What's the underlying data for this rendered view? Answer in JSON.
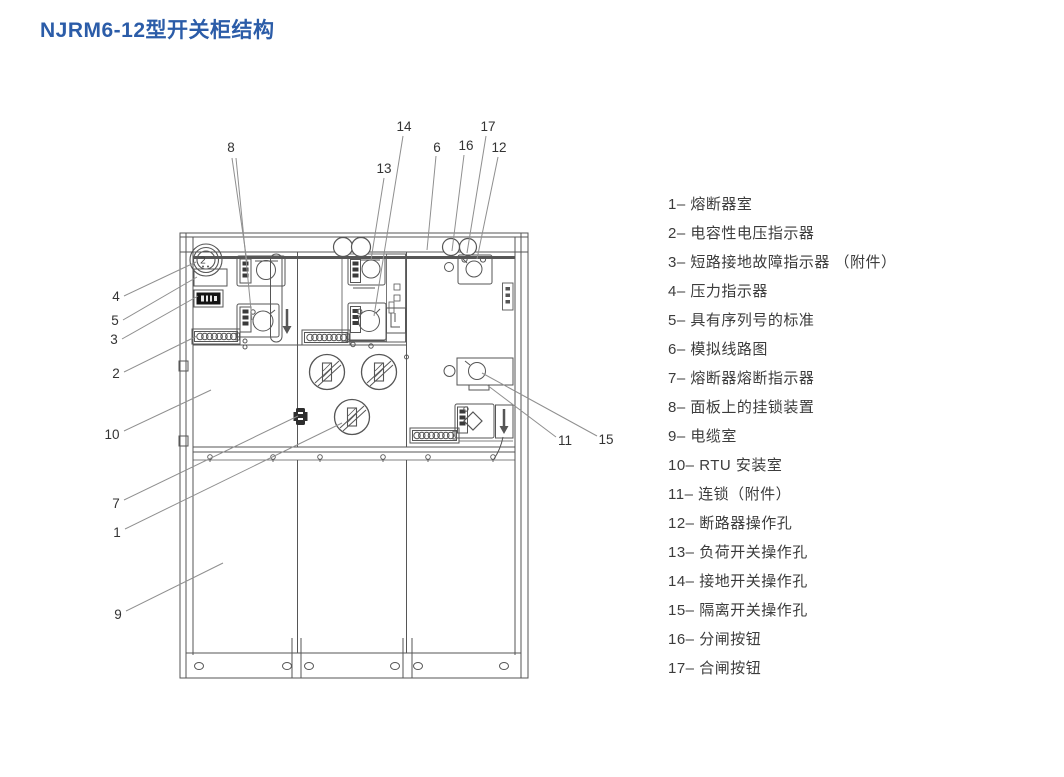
{
  "title": "NJRM6-12型开关柜结构",
  "colors": {
    "title": "#2b5ca8",
    "diagram_line": "#565656",
    "leader_line": "#8f8f8f",
    "legend_text": "#3c3c3c"
  },
  "legend": {
    "items": [
      {
        "label": "1– 熔断器室"
      },
      {
        "label": "2– 电容性电压指示器"
      },
      {
        "label": "3– 短路接地故障指示器 （附件）"
      },
      {
        "label": "4– 压力指示器"
      },
      {
        "label": "5– 具有序列号的标准"
      },
      {
        "label": "6– 模拟线路图"
      },
      {
        "label": "7– 熔断器熔断指示器"
      },
      {
        "label": "8– 面板上的挂锁装置"
      },
      {
        "label": "9– 电缆室"
      },
      {
        "label": "10– RTU 安装室"
      },
      {
        "label": "11– 连锁（附件）"
      },
      {
        "label": "12– 断路器操作孔"
      },
      {
        "label": "13– 负荷开关操作孔"
      },
      {
        "label": "14– 接地开关操作孔"
      },
      {
        "label": "15– 隔离开关操作孔"
      },
      {
        "label": "16– 分闸按钮"
      },
      {
        "label": "17– 合闸按钮"
      }
    ]
  },
  "diagram": {
    "gauge_glyph": "2",
    "callouts": [
      {
        "label": "8"
      },
      {
        "label": "13"
      },
      {
        "label": "14"
      },
      {
        "label": "6"
      },
      {
        "label": "16"
      },
      {
        "label": "17"
      },
      {
        "label": "12"
      },
      {
        "label": "4"
      },
      {
        "label": "5"
      },
      {
        "label": "3"
      },
      {
        "label": "2"
      },
      {
        "label": "10"
      },
      {
        "label": "7"
      },
      {
        "label": "1"
      },
      {
        "label": "9"
      },
      {
        "label": "11"
      },
      {
        "label": "15"
      }
    ]
  }
}
